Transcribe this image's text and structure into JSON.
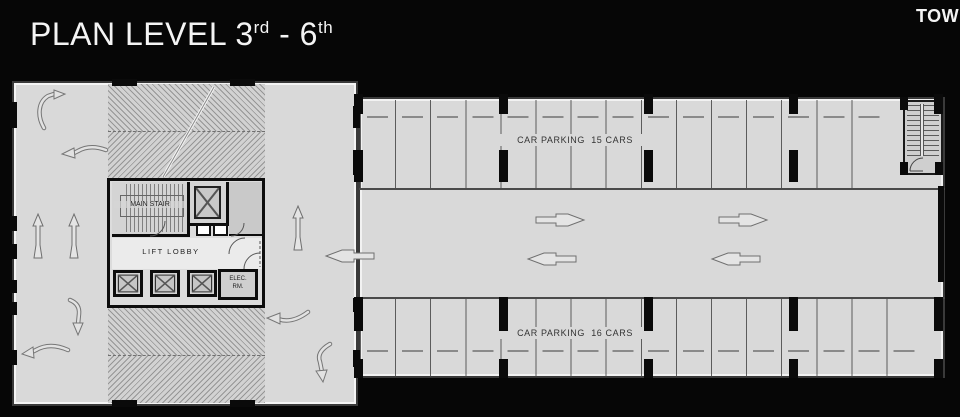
{
  "header": {
    "title_p1": "PLAN LEVEL 3",
    "title_sup1": "rd",
    "title_p2": " - 6",
    "title_sup2": "th",
    "corner_text": "TOW"
  },
  "plan": {
    "core": {
      "stair_label": "MAIN STAIR",
      "lobby_label": "LIFT LOBBY",
      "elec_line1": "ELEC.",
      "elec_line2": "RM."
    },
    "parking": {
      "top_label": "CAR PARKING  15 CARS",
      "bottom_label": "CAR PARKING  16 CARS"
    }
  },
  "colors": {
    "background": "#060606",
    "floor": "#d9d9d9",
    "wall": "#3a3a3a",
    "core_wall": "#0d0d0d",
    "text": "#2e2e2e"
  }
}
